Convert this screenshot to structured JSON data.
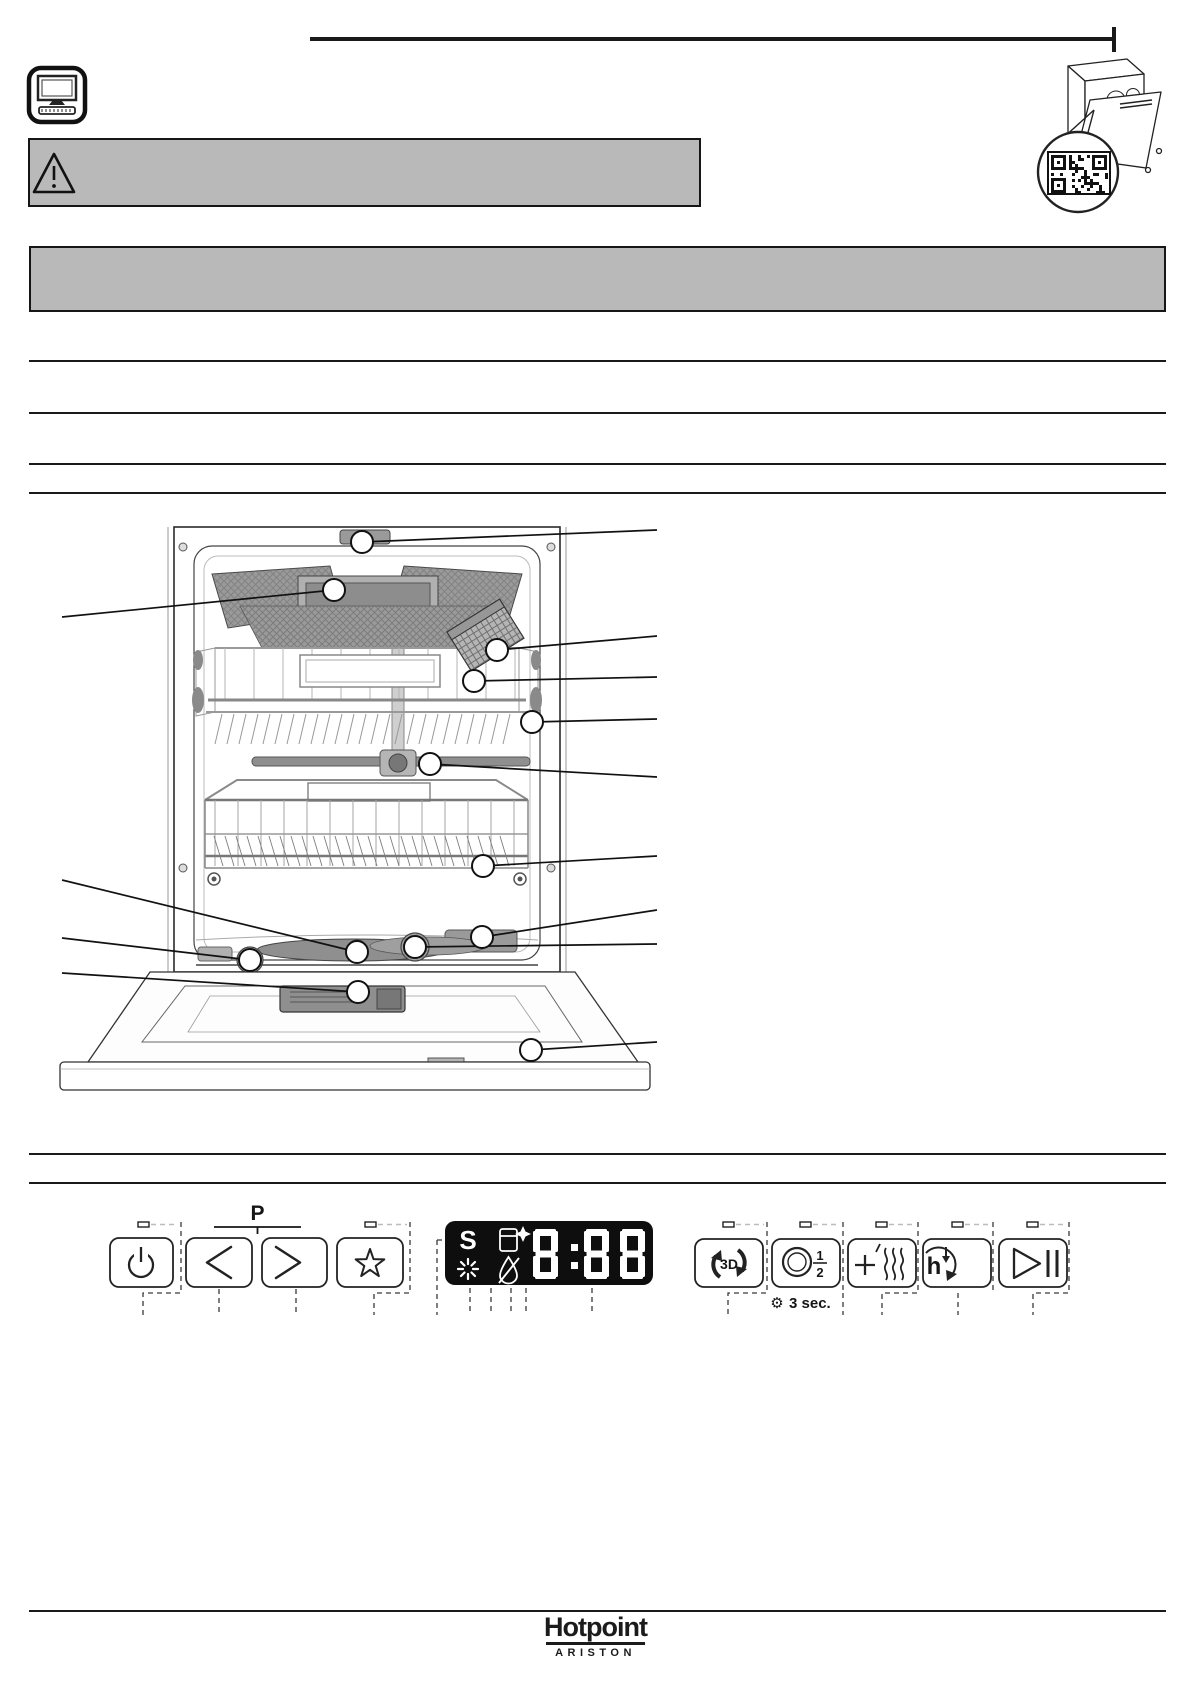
{
  "colors": {
    "box_gray": "#b9b9b9",
    "ink": "#161616",
    "display_bg": "#0e0e0e",
    "display_fg": "#ffffff"
  },
  "header": {
    "monitor_icon": "computer-monitor-icon",
    "warning_icon": "warning-triangle-icon",
    "qr_illustration": "dishwasher-with-qr-code"
  },
  "control_panel": {
    "program_label": "P",
    "hold_hint": {
      "glyph": "⚙",
      "text": "3 sec."
    },
    "buttons": [
      {
        "id": "power",
        "icon": "power-icon"
      },
      {
        "id": "program-previous",
        "icon": "chevron-left-icon"
      },
      {
        "id": "program-next",
        "icon": "chevron-right-icon"
      },
      {
        "id": "favorite",
        "icon": "star-icon"
      },
      {
        "id": "multizone-3d",
        "icon": "3d-zone-icon",
        "label": "3D"
      },
      {
        "id": "half-load",
        "icon": "half-load-icon",
        "numerator": "1",
        "denominator": "2"
      },
      {
        "id": "extra-drying",
        "icon": "heat-waves-icon"
      },
      {
        "id": "delayed-start",
        "icon": "delay-timer-icon",
        "label": "h"
      },
      {
        "id": "start-pause",
        "icon": "play-pause-icon"
      }
    ],
    "display": {
      "value": "8:88",
      "indicators": [
        {
          "id": "salt",
          "glyph": "S"
        },
        {
          "id": "rinse-aid",
          "icon": "bottle-sparkle-icon"
        },
        {
          "id": "wash-phase",
          "icon": "starburst-icon"
        },
        {
          "id": "water-supply",
          "icon": "crossed-drop-icon"
        }
      ]
    }
  },
  "diagram": {
    "callouts": [
      {
        "part": "water-supply-connection",
        "x": 362,
        "y": 542,
        "tx": 657,
        "ty": 530
      },
      {
        "part": "third-rack",
        "x": 334,
        "y": 590,
        "tx": 62,
        "ty": 617
      },
      {
        "part": "cutlery-basket",
        "x": 497,
        "y": 650,
        "tx": 657,
        "ty": 636
      },
      {
        "part": "upper-rack",
        "x": 474,
        "y": 681,
        "tx": 657,
        "ty": 677
      },
      {
        "part": "rack-rails",
        "x": 532,
        "y": 722,
        "tx": 657,
        "ty": 719
      },
      {
        "part": "middle-spray-arm",
        "x": 430,
        "y": 764,
        "tx": 657,
        "ty": 777
      },
      {
        "part": "lower-rack",
        "x": 483,
        "y": 866,
        "tx": 657,
        "ty": 856
      },
      {
        "part": "lower-spray-arm",
        "x": 482,
        "y": 937,
        "tx": 657,
        "ty": 910
      },
      {
        "part": "filter-assembly",
        "x": 415,
        "y": 947,
        "tx": 657,
        "ty": 944
      },
      {
        "part": "sprayer-hub",
        "x": 357,
        "y": 952,
        "tx": 62,
        "ty": 880
      },
      {
        "part": "salt-cap",
        "x": 250,
        "y": 960,
        "tx": 62,
        "ty": 938
      },
      {
        "part": "detergent-dispenser",
        "x": 358,
        "y": 992,
        "tx": 62,
        "ty": 973
      },
      {
        "part": "rating-plate",
        "x": 531,
        "y": 1050,
        "tx": 657,
        "ty": 1042
      }
    ]
  },
  "footer": {
    "brand": "Hotpoint",
    "sub_brand": "ARISTON"
  }
}
